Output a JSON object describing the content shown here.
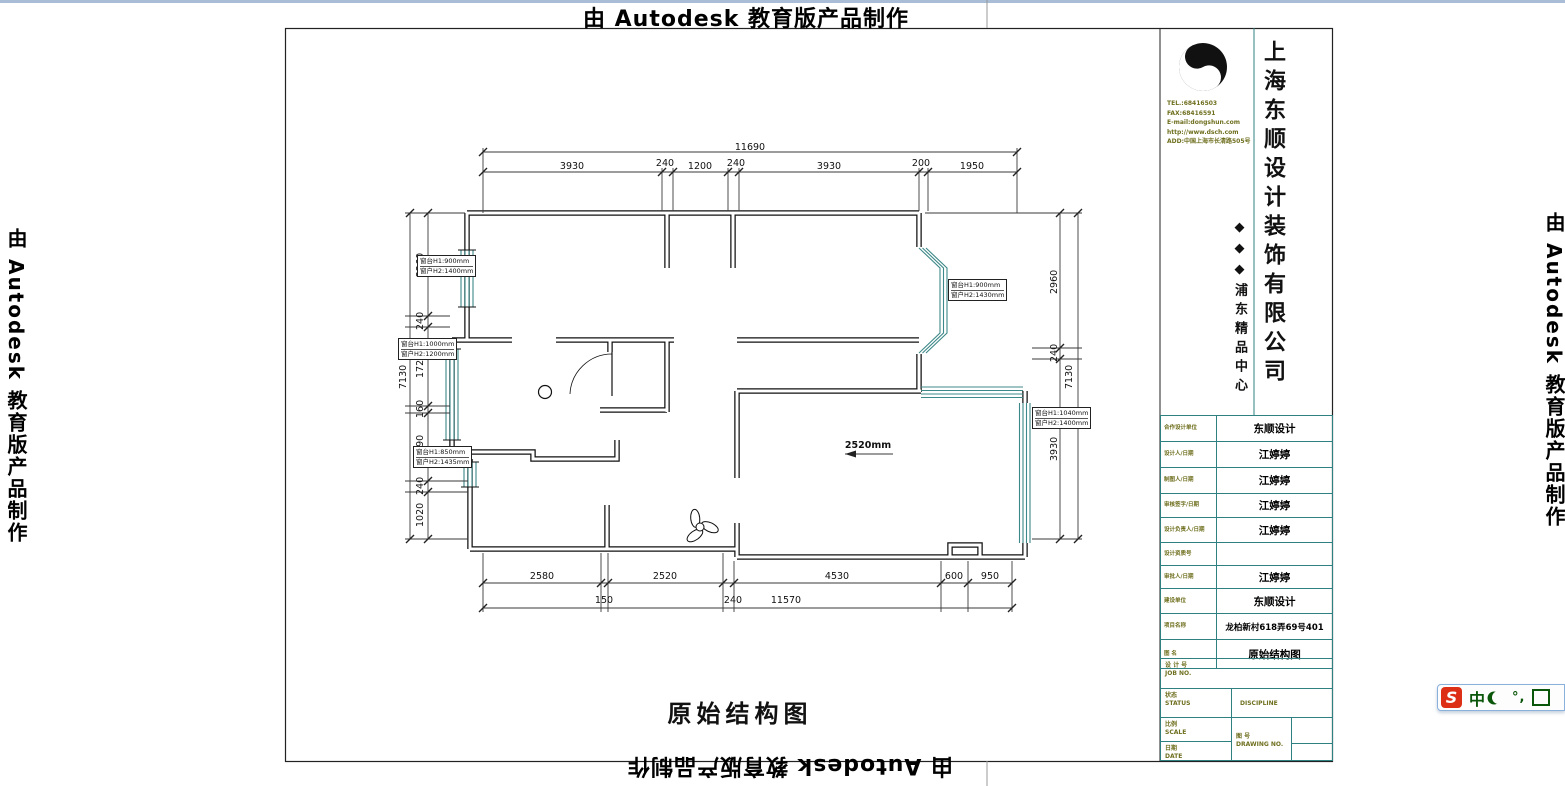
{
  "watermark": {
    "text": "由 Autodesk 教育版产品制作"
  },
  "drawing": {
    "title": "原始结构图",
    "room_annotation": "2520mm",
    "dim_labels": [
      {
        "text": "11690",
        "x": 750,
        "y": 142,
        "rot": false
      },
      {
        "text": "3930",
        "x": 572,
        "y": 161,
        "rot": false
      },
      {
        "text": "240",
        "x": 665,
        "y": 158,
        "rot": false
      },
      {
        "text": "1200",
        "x": 700,
        "y": 161,
        "rot": false
      },
      {
        "text": "240",
        "x": 736,
        "y": 158,
        "rot": false
      },
      {
        "text": "3930",
        "x": 829,
        "y": 161,
        "rot": false
      },
      {
        "text": "200",
        "x": 921,
        "y": 158,
        "rot": false
      },
      {
        "text": "1950",
        "x": 972,
        "y": 161,
        "rot": false
      },
      {
        "text": "2580",
        "x": 542,
        "y": 571,
        "rot": false
      },
      {
        "text": "2520",
        "x": 665,
        "y": 571,
        "rot": false
      },
      {
        "text": "4530",
        "x": 837,
        "y": 571,
        "rot": false
      },
      {
        "text": "600",
        "x": 954,
        "y": 571,
        "rot": false
      },
      {
        "text": "950",
        "x": 990,
        "y": 571,
        "rot": false
      },
      {
        "text": "150",
        "x": 604,
        "y": 595,
        "rot": false
      },
      {
        "text": "240",
        "x": 733,
        "y": 595,
        "rot": false
      },
      {
        "text": "11570",
        "x": 786,
        "y": 595,
        "rot": false
      },
      {
        "text": "2260",
        "x": 415,
        "y": 277,
        "rot": true
      },
      {
        "text": "240",
        "x": 415,
        "y": 330,
        "rot": true
      },
      {
        "text": "1720",
        "x": 415,
        "y": 378,
        "rot": true
      },
      {
        "text": "160",
        "x": 415,
        "y": 418,
        "rot": true
      },
      {
        "text": "1490",
        "x": 415,
        "y": 459,
        "rot": true
      },
      {
        "text": "240",
        "x": 415,
        "y": 495,
        "rot": true
      },
      {
        "text": "1020",
        "x": 415,
        "y": 527,
        "rot": true
      },
      {
        "text": "7130",
        "x": 398,
        "y": 389,
        "rot": true
      },
      {
        "text": "2960",
        "x": 1049,
        "y": 294,
        "rot": true
      },
      {
        "text": "240",
        "x": 1049,
        "y": 362,
        "rot": true
      },
      {
        "text": "3930",
        "x": 1049,
        "y": 461,
        "rot": true
      },
      {
        "text": "7130",
        "x": 1064,
        "y": 389,
        "rot": true
      }
    ],
    "window_labels": [
      {
        "x": 417,
        "y": 255,
        "line1": "窗台H1:900mm",
        "line2": "窗户H2:1400mm"
      },
      {
        "x": 398,
        "y": 338,
        "line1": "窗台H1:1000mm",
        "line2": "窗户H2:1200mm"
      },
      {
        "x": 413,
        "y": 446,
        "line1": "窗台H1:850mm",
        "line2": "窗户H2:1435mm"
      },
      {
        "x": 948,
        "y": 279,
        "line1": "窗台H1:900mm",
        "line2": "窗户H2:1430mm"
      },
      {
        "x": 1032,
        "y": 407,
        "line1": "窗台H1:1040mm",
        "line2": "窗户H2:1400mm"
      }
    ]
  },
  "title_block": {
    "company_name": "上海东顺设计装饰有限公司",
    "sub_brand": "◆◆◆浦东精品中心",
    "contact_lines": [
      "TEL.:68416503",
      "FAX:68416591",
      "E-mail:dongshun.com",
      "http://www.dsch.com",
      "ADD:中国上海市长清路505号"
    ],
    "rows": [
      {
        "label": "合作设计单位",
        "value": "东顺设计",
        "small": false
      },
      {
        "label": "设计人/日期",
        "value": "江婷婷",
        "small": false
      },
      {
        "label": "制图人/日期",
        "value": "江婷婷",
        "small": false
      },
      {
        "label": "审核签字/日期",
        "value": "江婷婷",
        "small": false
      },
      {
        "label": "设计负责人/日期",
        "value": "江婷婷",
        "small": false
      },
      {
        "label": "设计资质号",
        "value": "",
        "small": false
      },
      {
        "label": "审批人/日期",
        "value": "江婷婷",
        "small": false
      },
      {
        "label": "建设单位",
        "value": "东顺设计",
        "small": false
      },
      {
        "label": "项目名称",
        "value": "龙柏新村618弄69号401",
        "small": true
      },
      {
        "label": "图  名",
        "value": "原始结构图",
        "small": false
      }
    ],
    "bottom": {
      "job_label": "设 计 号",
      "job_en": "JOB NO.",
      "status_label": "状态",
      "status_en": "STATUS",
      "discipline_en": "DISCIPLINE",
      "scale_label": "比例",
      "scale_en": "SCALE",
      "drawing_label": "图  号",
      "drawing_en": "DRAWING NO.",
      "date_label": "日期",
      "date_en": "DATE"
    }
  },
  "ime_bar": {
    "logo": "S",
    "mode": "中",
    "punct": "°,"
  },
  "colors": {
    "window_teal": "#3d8888",
    "table_line": "#2f8080",
    "label_olive": "#6f6f1f",
    "ime_green": "#0a560a",
    "ime_red": "#dd2f16",
    "edge_strip": "#a9bdd6"
  }
}
